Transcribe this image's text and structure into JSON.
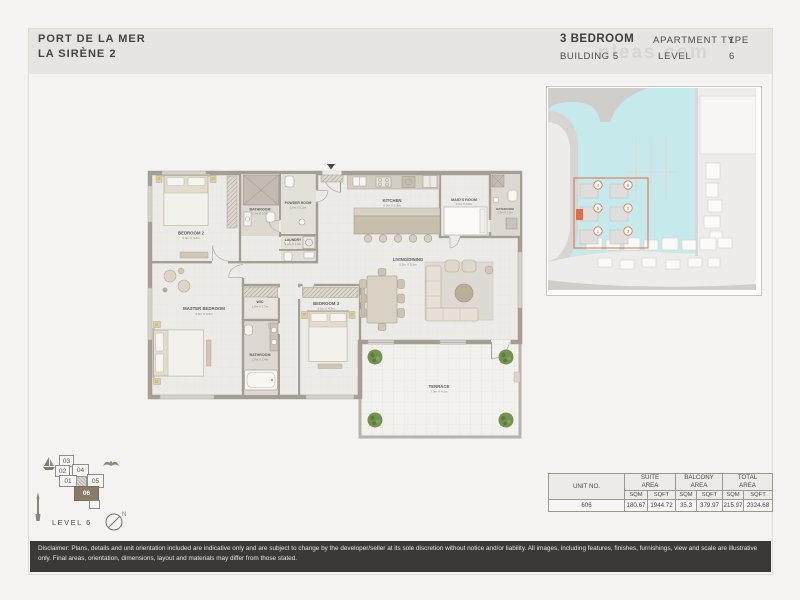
{
  "header": {
    "project_line1": "PORT DE LA MER",
    "project_line2": "LA SIRÈNE 2",
    "unit_type": "3 BEDROOM",
    "apartment_label": "APARTMENT TYPE",
    "apartment_type_value": "1",
    "building_label": "BUILDING 5",
    "level_label": "LEVEL",
    "level_value": "6",
    "watermark": "nleas.com"
  },
  "floor_plan": {
    "rooms": {
      "bedroom2": {
        "name": "BEDROOM 2",
        "dims": "4.0m X 4.4m"
      },
      "bathroom2": {
        "name": "BATHROOM",
        "dims": "1.9m X 2.7m"
      },
      "powder": {
        "name": "POWDER ROOM",
        "dims": "1.6m X 1.5m"
      },
      "laundry": {
        "name": "LAUNDRY",
        "dims": "1.6m X 1.2m"
      },
      "kitchen": {
        "name": "KITCHEN",
        "dims": "4.3m X 2.8m"
      },
      "maids_room": {
        "name": "MAID'S ROOM",
        "dims": "2.0m X 3.0m"
      },
      "bathroom_maids": {
        "name": "BATHROOM",
        "dims": "1.5m X 2.0m"
      },
      "living_dining": {
        "name": "LIVING/DINING",
        "dims": "5.2m X 5.5m"
      },
      "master_bedroom": {
        "name": "MASTER BEDROOM",
        "dims": "4.0m X 4.5m"
      },
      "wic": {
        "name": "WIC",
        "dims": "1.8m X 1.7m"
      },
      "bathroom_master": {
        "name": "BATHROOM",
        "dims": "1.8m X 2.4m"
      },
      "bedroom3": {
        "name": "BEDROOM 3",
        "dims": "3.6m X 4.7m"
      },
      "terrace": {
        "name": "TERRACE",
        "dims": "7.0m X 4.2m"
      }
    }
  },
  "site_map": {
    "cluster_buildings": [
      "4",
      "6",
      "5",
      "2",
      "1",
      "3"
    ],
    "highlighted_building": "5"
  },
  "unit_key": {
    "units": [
      "03",
      "02",
      "04",
      "01",
      "05",
      "06"
    ],
    "highlighted_unit": "06",
    "level_text": "LEVEL 6",
    "compass_label": "N"
  },
  "area_table": {
    "col_unit": "UNIT NO.",
    "col_suite": "SUITE AREA",
    "col_balcony": "BALCONY AREA",
    "col_total": "TOTAL AREA",
    "sub_sqm": "SQM",
    "sub_sqft": "SQFT",
    "row": {
      "unit_no": "606",
      "suite_sqm": "180.67",
      "suite_sqft": "1944.72",
      "balcony_sqm": "35.3",
      "balcony_sqft": "379.97",
      "total_sqm": "215.97",
      "total_sqft": "2324.68"
    }
  },
  "disclaimer": "Disclaimer: Plans, details and unit orientation included are indicative only and are subject to change by the developer/seller at its sole discretion without notice and/or liability. All images, including features, finishes, furnishings, view and scale are illustrative only. Final areas, orientation, dimensions, layout and materials may differ from those stated.",
  "colors": {
    "accent_orange": "#df6e45",
    "highlight_brown": "#8a7a68",
    "water": "#c6e9ec",
    "wall": "#a59e95"
  }
}
